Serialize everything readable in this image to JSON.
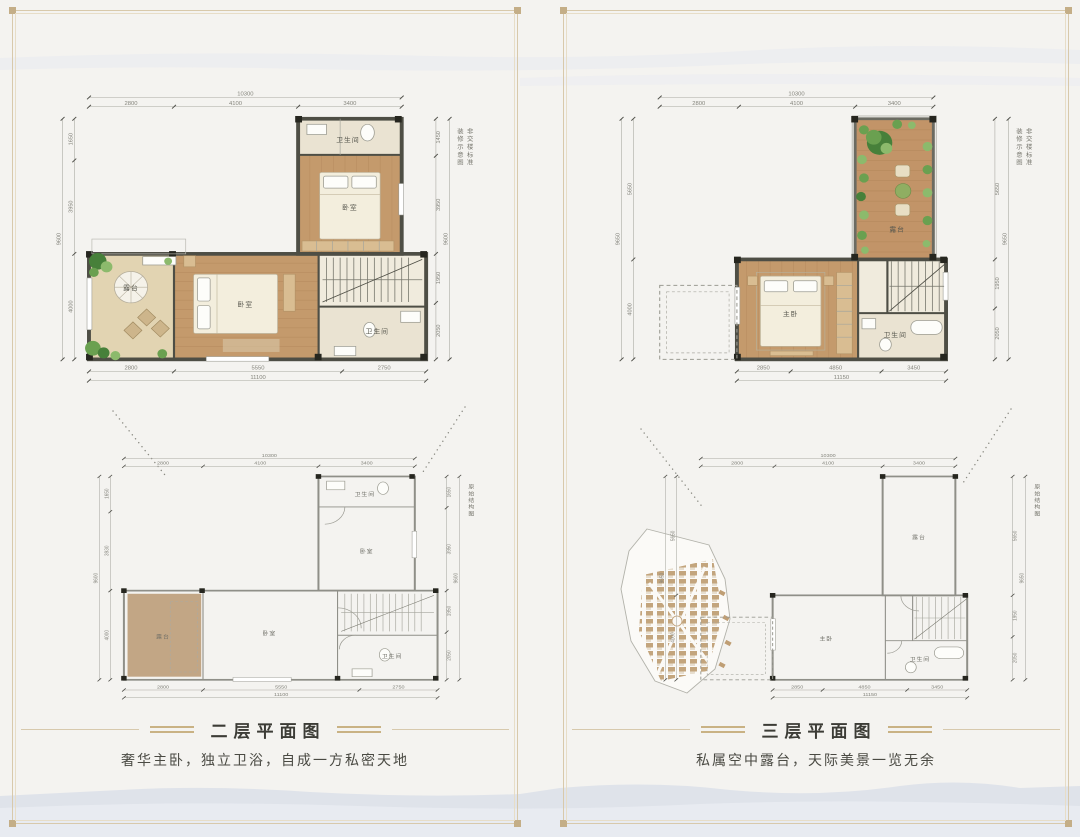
{
  "decor": {
    "bg_color": "#f4f3f0",
    "frame_color": "#d8c9ab",
    "accent_gold": "#c9b284",
    "mountain_color": "#dde2ea",
    "wall_color": "#4e4e45",
    "wood_floor_color": "#c49a6c",
    "terrace_sand_color": "#e2d4b2",
    "structural_terrace_fill": "#c2a685"
  },
  "panels": [
    {
      "caption": "二层平面图",
      "tagline": "奢华主卧，独立卫浴，自成一方私密天地",
      "top_plan": {
        "annotation_1": "装修示意图",
        "annotation_2": "非交楼标准",
        "rooms": {
          "bath_top": "卫生间",
          "bed_top": "卧室",
          "bed_mid": "卧室",
          "terrace": "露台",
          "bath_low": "卫生间"
        },
        "dims": {
          "top": [
            "2800",
            "4100",
            "3400"
          ],
          "top_total": "10300",
          "bottom": [
            "2800",
            "5550",
            "2750"
          ],
          "bottom_total": "11100",
          "left": [
            "1650",
            "3950",
            "4000"
          ],
          "left_total": "9600",
          "right": [
            "1450",
            "3950",
            "1950",
            "2050"
          ],
          "right_total": "9600"
        }
      },
      "bottom_plan": {
        "annotation_1": "原始结构图",
        "rooms": {
          "bath_top": "卫生间",
          "bed_top": "卧室",
          "bed_mid": "卧室",
          "terrace": "露台",
          "bath_low": "卫生间"
        },
        "dims": {
          "top": [
            "2800",
            "4100",
            "3400"
          ],
          "top_total": "10300",
          "bottom": [
            "2800",
            "5550",
            "2750"
          ],
          "bottom_total": "11100",
          "left": [
            "1650",
            "3930",
            "4000"
          ],
          "left_total": "9600",
          "right": [
            "1650",
            "3950",
            "1950",
            "2050"
          ],
          "right_total": "9600"
        }
      }
    },
    {
      "caption": "三层平面图",
      "tagline": "私属空中露台，天际美景一览无余",
      "top_plan": {
        "annotation_1": "装修示意图",
        "annotation_2": "非交楼标准",
        "rooms": {
          "terrace": "露台",
          "master": "主卧",
          "bath": "卫生间"
        },
        "dims": {
          "top": [
            "2800",
            "4100",
            "3400"
          ],
          "top_total": "10300",
          "bottom": [
            "2850",
            "4850",
            "3450"
          ],
          "bottom_total": "11150",
          "left": [
            "5650",
            "4000"
          ],
          "left_total": "9650",
          "right": [
            "5650",
            "1950",
            "2050"
          ],
          "right_total": "9650"
        }
      },
      "bottom_plan": {
        "annotation_1": "原始结构图",
        "rooms": {
          "terrace": "露台",
          "master": "主卧",
          "bath": "卫生间"
        },
        "dims": {
          "top": [
            "2800",
            "4100",
            "3400"
          ],
          "top_total": "10300",
          "bottom": [
            "2850",
            "4850",
            "3450"
          ],
          "bottom_total": "11150",
          "left": [
            "5650",
            "4000"
          ],
          "left_total": "9650",
          "right": [
            "5650",
            "1950",
            "2050"
          ],
          "right_total": "9650"
        }
      }
    }
  ]
}
